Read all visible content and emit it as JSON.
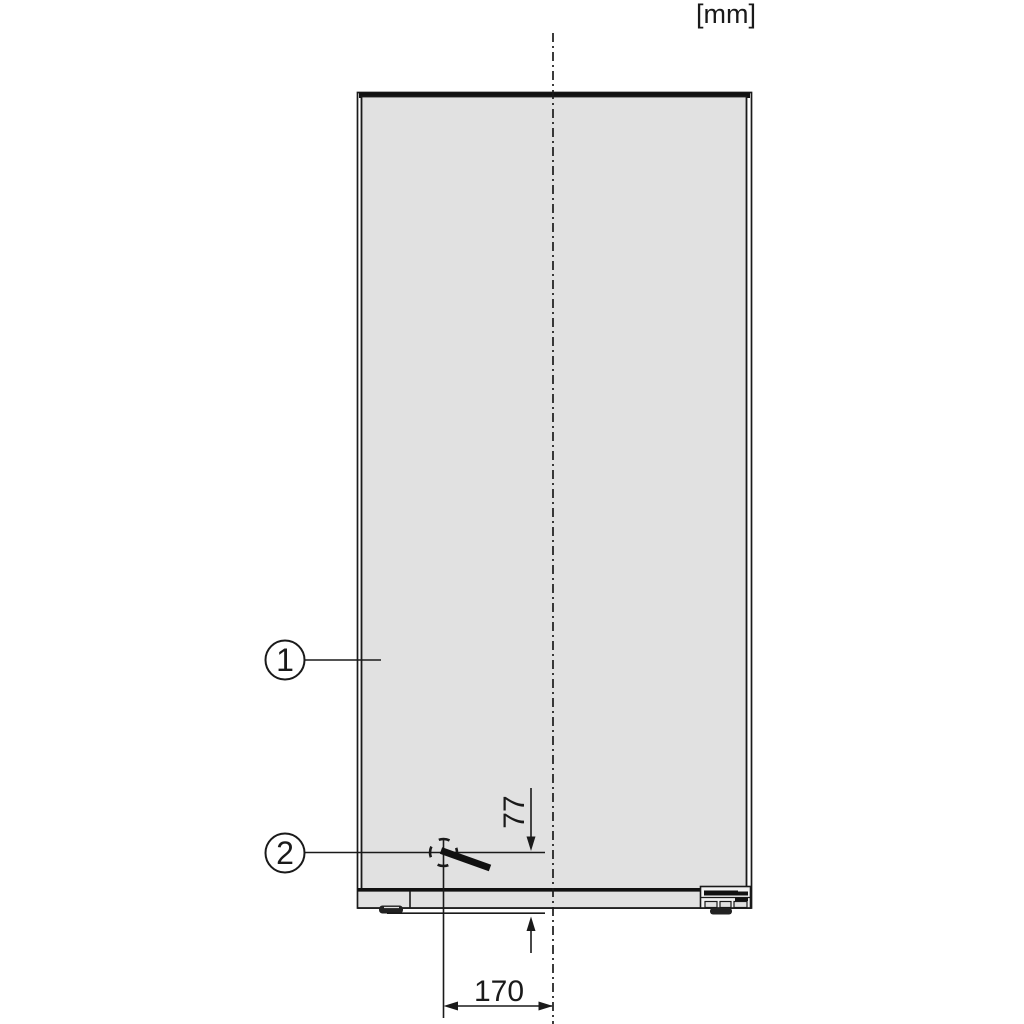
{
  "figure": {
    "type": "appliance-installation-diagram",
    "unit_label": "[mm]",
    "callouts": [
      {
        "id": "1",
        "label": "1",
        "meaning": "appliance-front-panel"
      },
      {
        "id": "2",
        "label": "2",
        "meaning": "connection-point-marker"
      }
    ],
    "dimensions": [
      {
        "value": "77",
        "orientation": "vertical",
        "measures": "connection-point-height-above-base"
      },
      {
        "value": "170",
        "orientation": "horizontal",
        "measures": "connection-point-offset-from-centerline"
      }
    ],
    "colors": {
      "panel_fill": "#e1e1e1",
      "line": "#1a1a1a",
      "dark_fill": "#111111",
      "background": "#ffffff"
    }
  }
}
